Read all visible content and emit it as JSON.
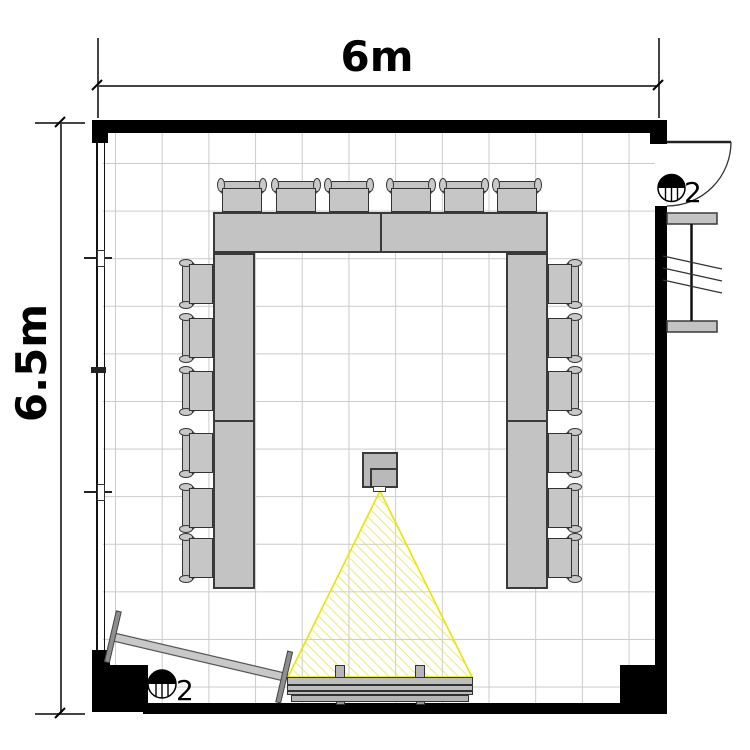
{
  "drawing": {
    "kind": "meeting-room floor plan",
    "dimensions": {
      "width": "6m",
      "height": "6.5m"
    },
    "fixtures": {
      "door_side_label": "2",
      "corner_label": "2"
    },
    "furniture": {
      "chairs_count": 18,
      "table_segments": 6,
      "has_projector": true,
      "has_projection_beam": true,
      "has_media_board": true,
      "has_leaning_whiteboard": true,
      "has_radiator": true,
      "has_door": true
    },
    "colors": {
      "wall": "#000000",
      "furniture_fill": "#c3c3c3",
      "furniture_outline": "#3a3a3a",
      "grid_line": "#cbcbcb",
      "beam_border": "#e6e600",
      "beam_hatch": "#e2e240"
    }
  }
}
